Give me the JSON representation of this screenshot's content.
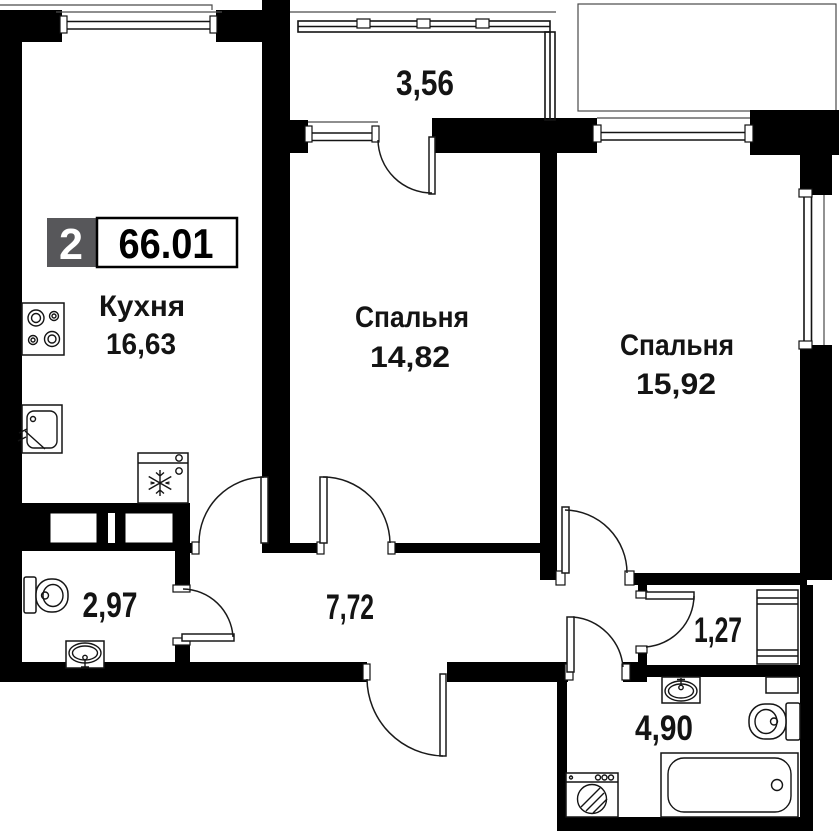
{
  "badge": {
    "room_count": "2",
    "total_area": "66.01"
  },
  "rooms": {
    "kitchen": {
      "name": "Кухня",
      "area": "16,63"
    },
    "bedroom1": {
      "name": "Спальня",
      "area": "14,82"
    },
    "bedroom2": {
      "name": "Спальня",
      "area": "15,92"
    },
    "balcony": {
      "area": "3,56"
    },
    "wc": {
      "area": "2,97"
    },
    "hallway": {
      "area": "7,72"
    },
    "storage": {
      "area": "1,27"
    },
    "bathroom": {
      "area": "4,90"
    }
  },
  "icons": {
    "kitchen": [
      "stove-icon",
      "kitchen-sink-icon",
      "fridge-icon"
    ],
    "wc": [
      "toilet-icon",
      "washbasin-icon"
    ],
    "bathroom": [
      "washbasin-icon",
      "toilet-icon",
      "bathtub-icon",
      "washing-machine-icon",
      "water-heater-icon"
    ],
    "storage": [
      "wardrobe-icon"
    ]
  },
  "colors": {
    "wall": "#000000",
    "badge_bg": "#57575a",
    "badge_value_bg": "#ffffff",
    "text": "#141414",
    "background": "#ffffff"
  }
}
